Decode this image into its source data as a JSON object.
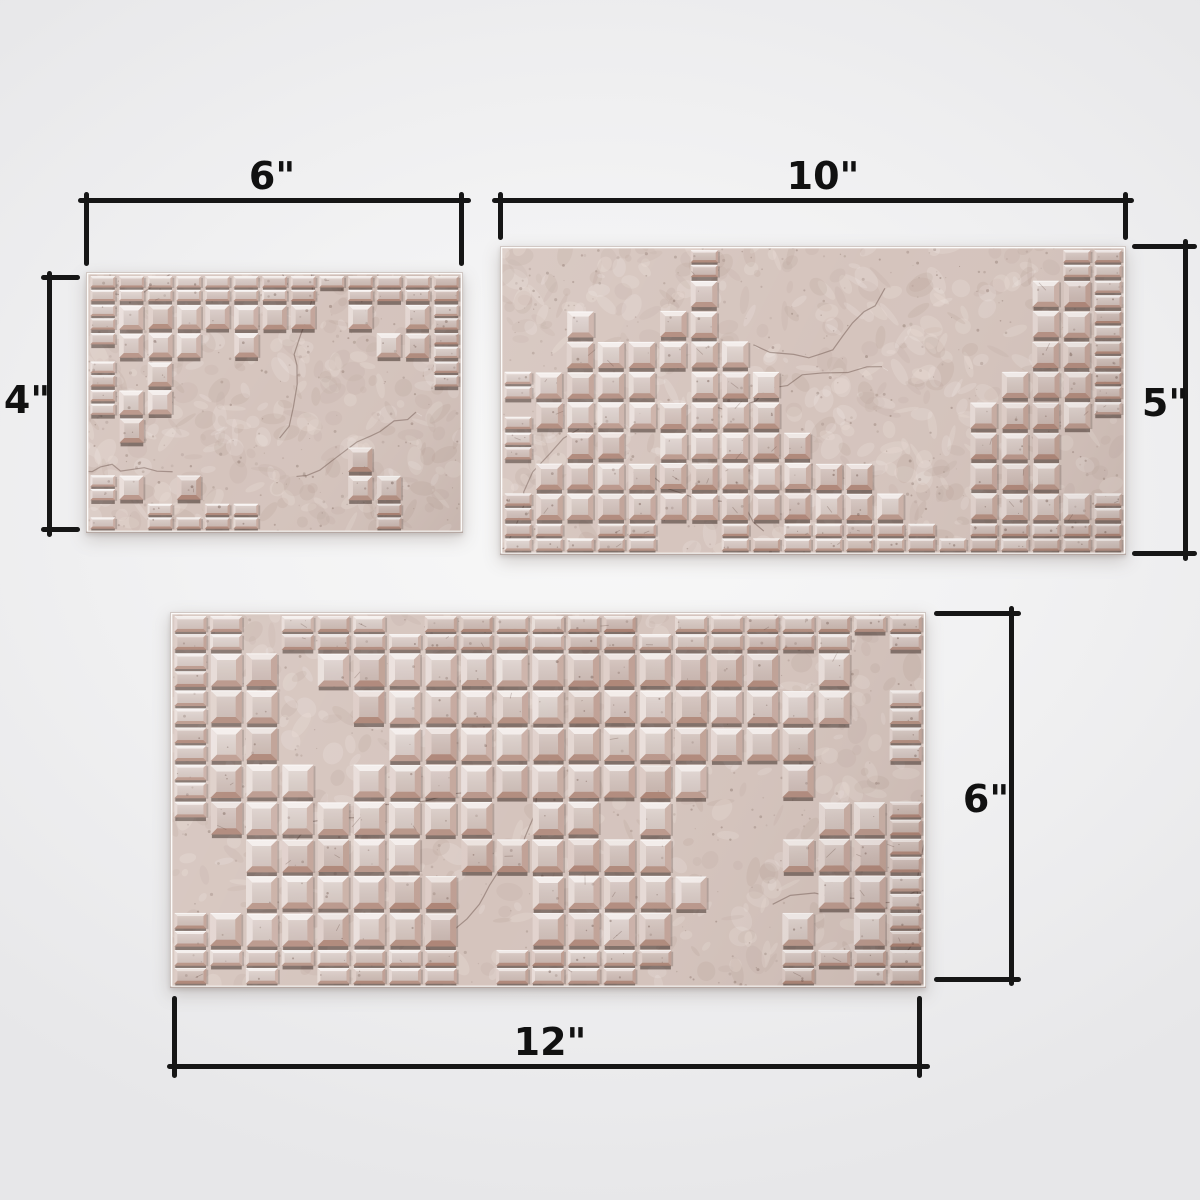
{
  "diagram": {
    "title": "Mosaic tile panel size comparison",
    "panels": [
      {
        "id": "panel-6x4",
        "width_label": "6\"",
        "height_label": "4\"",
        "width_inches": 6,
        "height_inches": 4
      },
      {
        "id": "panel-10x5",
        "width_label": "10\"",
        "height_label": "5\"",
        "width_inches": 10,
        "height_inches": 5
      },
      {
        "id": "panel-12x6",
        "width_label": "12\"",
        "height_label": "6\"",
        "width_inches": 12,
        "height_inches": 6
      }
    ],
    "colors": {
      "background_center": "#f8f8f8",
      "background_edge": "#e7e7e9",
      "dimension_line": "#161616",
      "label_text": "#111111",
      "tile_face": "#ddccc5",
      "tile_highlight": "#f2e9e5",
      "tile_bevel_dark": "#a8948c",
      "tile_under_shadow": "#32211b",
      "plaster": "#d5c4bd"
    }
  }
}
